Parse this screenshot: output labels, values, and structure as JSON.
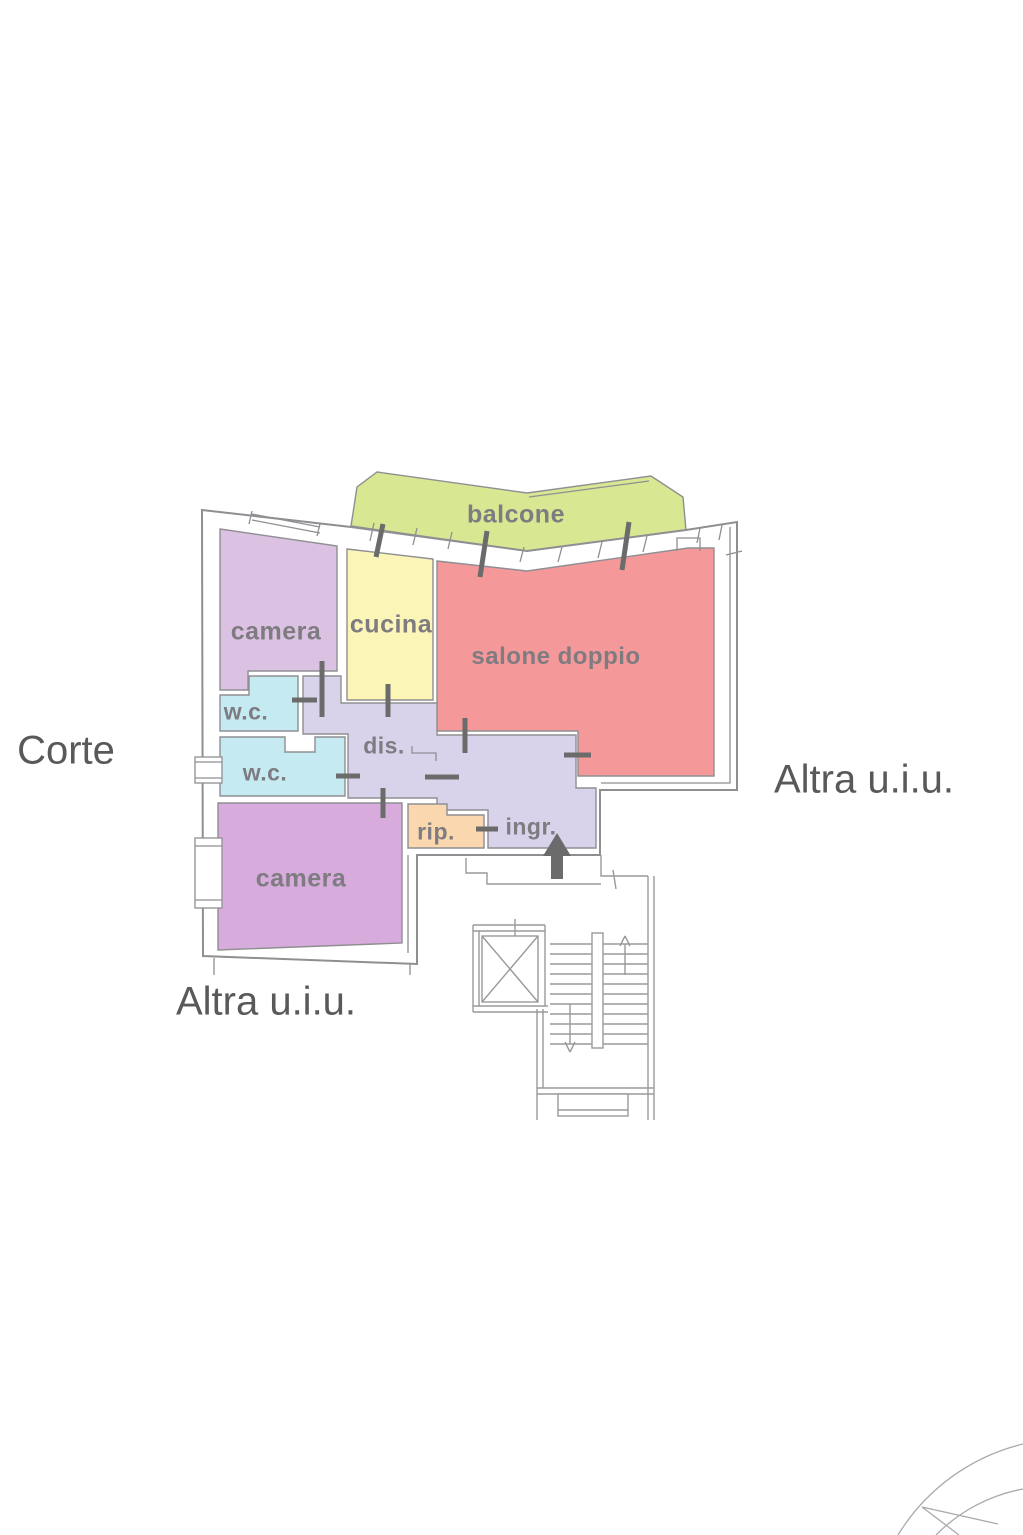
{
  "canvas": {
    "width": 1023,
    "height": 1535,
    "background": "#ffffff"
  },
  "colors": {
    "wall": "#8f8f93",
    "stair_line": "#9a9a9e",
    "marker": "#6b6b6b",
    "arc": "#aaaaae"
  },
  "rooms": [
    {
      "id": "balcone",
      "label": "balcone",
      "fill": "#d7e792"
    },
    {
      "id": "camera-nord",
      "label": "camera",
      "fill": "#dcc2e2"
    },
    {
      "id": "cucina",
      "label": "cucina",
      "fill": "#fbf5b8"
    },
    {
      "id": "salone-doppio",
      "label": "salone doppio",
      "fill": "#f49899"
    },
    {
      "id": "wc-1",
      "label": "w.c.",
      "fill": "#c5eaf2"
    },
    {
      "id": "wc-2",
      "label": "w.c.",
      "fill": "#c5eaf2"
    },
    {
      "id": "disimpegno",
      "label": "dis.",
      "fill": "#d8d3ea"
    },
    {
      "id": "ripostiglio",
      "label": "rip.",
      "fill": "#fad7ae"
    },
    {
      "id": "ingresso",
      "label": "ingr."
    },
    {
      "id": "camera-sud",
      "label": "camera",
      "fill": "#d7abdc"
    }
  ],
  "outside_labels": [
    {
      "id": "corte",
      "text": "Corte"
    },
    {
      "id": "altra-uiu-destra",
      "text": "Altra u.i.u."
    },
    {
      "id": "altra-uiu-basso",
      "text": "Altra u.i.u."
    }
  ],
  "entrance": {
    "marker": "up-arrow"
  }
}
